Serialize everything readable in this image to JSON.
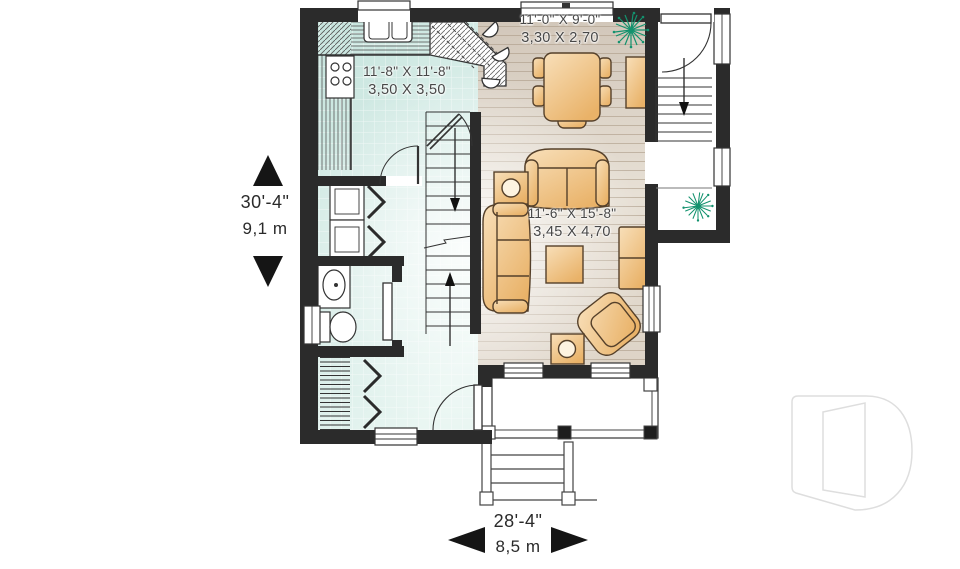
{
  "labels": {
    "kitchen": {
      "imperial": "11'-8\" X 11'-8\"",
      "metric": "3,50 X 3,50"
    },
    "dining": {
      "imperial": "11'-0\" X 9'-0\"",
      "metric": "3,30 X 2,70"
    },
    "living": {
      "imperial": "11'-6\" X 15'-8\"",
      "metric": "3,45 X 4,70"
    },
    "overall_height": {
      "imperial": "30'-4\"",
      "metric": "9,1 m"
    },
    "overall_width": {
      "imperial": "28'-4\"",
      "metric": "8,5 m"
    }
  },
  "colors": {
    "wall": "#2b2b2b",
    "tile_floor": "#cde8e2",
    "wood_floor": "#d7cdc0",
    "furniture": "#eeb96f",
    "plant": "#13926e",
    "text": "#3f3f3f",
    "logo_outline": "#dedede"
  }
}
